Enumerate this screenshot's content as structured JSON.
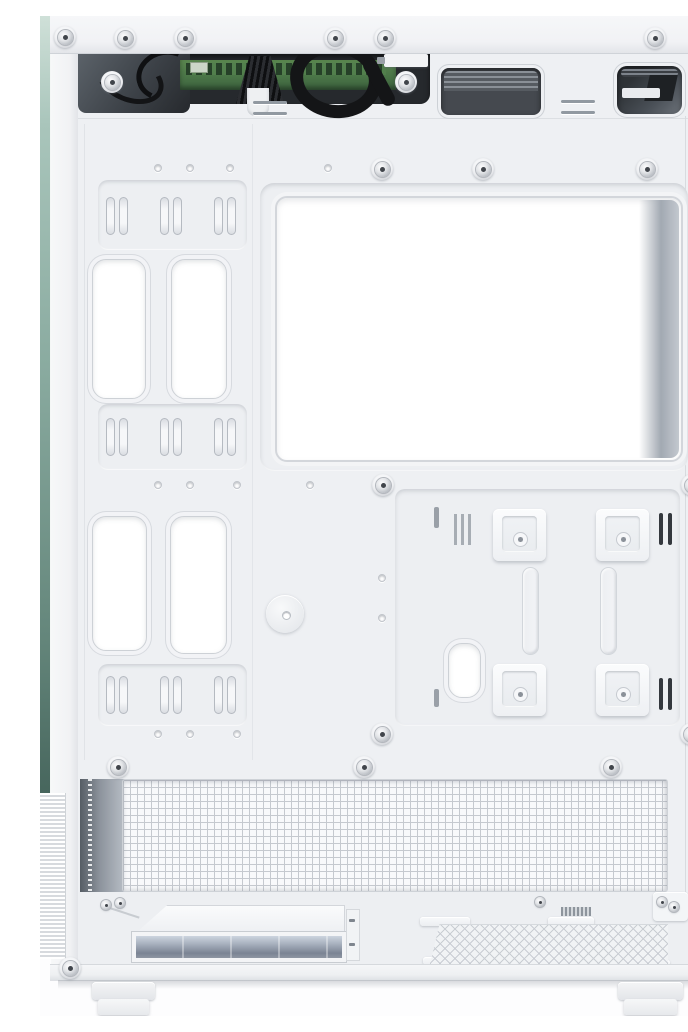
{
  "meta": {
    "description": "Product photo: interior of a white ATX mid-tower PC case with the side panel removed, showing the motherboard tray, CPU cooler cutout, cable-routing grommets, cable tie points, SSD mounting brackets, bottom dust mesh, PSU compartment with drive cage, and two case feet",
    "product_type": "pc-case-interior",
    "view": "side-on",
    "background": "#fdfdfe"
  },
  "colors": {
    "case_white": "#eef0f3",
    "panel_white": "#f4f5f7",
    "bright_cutout": "#ffffff",
    "dark_opening": "#26292d",
    "pcb_green": "#4a7547",
    "cable_black": "#141517",
    "mesh_grid": "#c5c9cf",
    "glass_edge_green": "#8aaba0",
    "cutout_shadow": "#a2a9b2"
  },
  "counts": {
    "cable_grommets": 5,
    "cable_tie_points": 9,
    "ssd_mount_brackets": 4,
    "visible_screws": 26,
    "screw_holes": 13,
    "case_feet": 2
  },
  "points": {
    "tie_panels": [
      [
        58,
        164,
        149,
        70
      ],
      [
        58,
        388,
        149,
        66
      ],
      [
        58,
        648,
        149,
        62
      ]
    ],
    "grommets": [
      [
        52,
        243,
        54,
        140
      ],
      [
        131,
        243,
        56,
        140
      ],
      [
        52,
        500,
        55,
        135
      ],
      [
        130,
        500,
        57,
        138
      ],
      [
        408,
        627,
        33,
        55
      ]
    ],
    "tie_points": [
      [
        77,
        200
      ],
      [
        131,
        200
      ],
      [
        185,
        200
      ],
      [
        77,
        421
      ],
      [
        131,
        421
      ],
      [
        185,
        421
      ],
      [
        77,
        679
      ],
      [
        131,
        679
      ],
      [
        185,
        679
      ]
    ],
    "brackets": [
      [
        453,
        493
      ],
      [
        556,
        493
      ],
      [
        453,
        648
      ],
      [
        556,
        648
      ]
    ],
    "dark_slot_pairs": [
      [
        619,
        497
      ],
      [
        619,
        662
      ]
    ],
    "grooves": [
      [
        482,
        551
      ],
      [
        560,
        551
      ]
    ],
    "bosses_screws": [
      [
        25,
        21
      ],
      [
        85,
        22
      ],
      [
        145,
        22
      ],
      [
        295,
        22
      ],
      [
        345,
        22
      ],
      [
        615,
        22
      ],
      [
        668,
        22
      ],
      [
        30,
        952
      ],
      [
        663,
        946
      ],
      [
        366,
        66
      ],
      [
        72,
        66
      ],
      [
        342,
        153
      ],
      [
        443,
        153
      ],
      [
        607,
        153
      ],
      [
        343,
        469
      ],
      [
        652,
        469
      ],
      [
        342,
        718
      ],
      [
        651,
        718
      ],
      [
        78,
        751
      ],
      [
        324,
        751
      ],
      [
        571,
        751
      ]
    ],
    "small_screws": [
      [
        66,
        889
      ],
      [
        80,
        887
      ],
      [
        500,
        886
      ],
      [
        622,
        886
      ],
      [
        634,
        891
      ]
    ],
    "holes": [
      [
        118,
        152
      ],
      [
        150,
        152
      ],
      [
        190,
        152
      ],
      [
        288,
        152
      ],
      [
        118,
        469
      ],
      [
        150,
        469
      ],
      [
        197,
        469
      ],
      [
        270,
        469
      ],
      [
        118,
        718
      ],
      [
        150,
        718
      ],
      [
        197,
        718
      ],
      [
        342,
        562
      ],
      [
        342,
        602
      ]
    ]
  }
}
